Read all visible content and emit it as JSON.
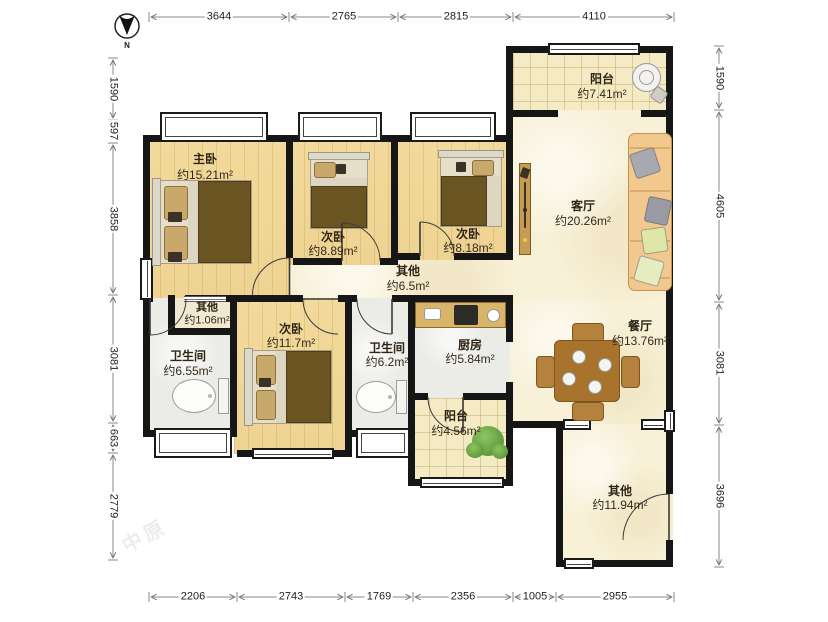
{
  "compass": {
    "label": "N"
  },
  "watermark": "中原",
  "dimensions": {
    "top": [
      "3644",
      "2765",
      "2815",
      "4110"
    ],
    "bottom": [
      "2206",
      "2743",
      "1769",
      "2356",
      "1005",
      "2955"
    ],
    "left": [
      "1590",
      "597",
      "3858",
      "3081",
      "663",
      "2779"
    ],
    "right": [
      "1590",
      "4605",
      "3081",
      "3696"
    ]
  },
  "rooms": {
    "master": {
      "name": "主卧",
      "area": "约15.21m²"
    },
    "bedroom2": {
      "name": "次卧",
      "area": "约8.89m²"
    },
    "bedroom3": {
      "name": "次卧",
      "area": "约8.18m²"
    },
    "bedroom4": {
      "name": "次卧",
      "area": "约11.7m²"
    },
    "living": {
      "name": "客厅",
      "area": "约20.26m²"
    },
    "dining": {
      "name": "餐厅",
      "area": "约13.76m²"
    },
    "balcony1": {
      "name": "阳台",
      "area": "约7.41m²"
    },
    "balcony2": {
      "name": "阳台",
      "area": "约4.56m²"
    },
    "bath1": {
      "name": "卫生间",
      "area": "约6.55m²"
    },
    "bath2": {
      "name": "卫生间",
      "area": "约6.2m²"
    },
    "kitchen": {
      "name": "厨房",
      "area": "约5.84m²"
    },
    "hall": {
      "name": "其他",
      "area": "约6.5m²"
    },
    "closet": {
      "name": "其他",
      "area": "约1.06m²"
    },
    "entry": {
      "name": "其他",
      "area": "约11.94m²"
    }
  }
}
